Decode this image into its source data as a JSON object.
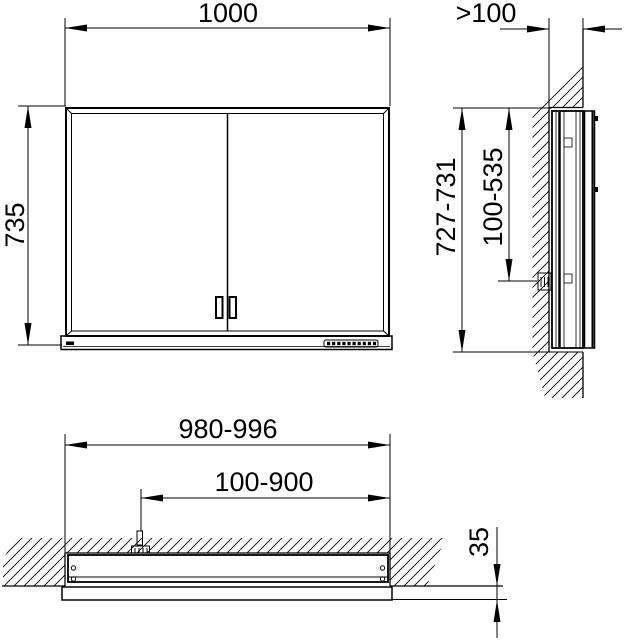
{
  "drawing": {
    "type": "technical-installation-drawing",
    "subject": "recessed mirror cabinet",
    "line_color": "#000000",
    "background_color": "#ffffff"
  },
  "front_view": {
    "width_label": "1000",
    "height_label": "735"
  },
  "side_view": {
    "niche_depth_label": ">100",
    "height_label": "727-731",
    "connection_height_label": "100-535"
  },
  "plan_view": {
    "cutout_width_label": "980-996",
    "connection_range_label": "100-900",
    "protrusion_label": "35"
  }
}
